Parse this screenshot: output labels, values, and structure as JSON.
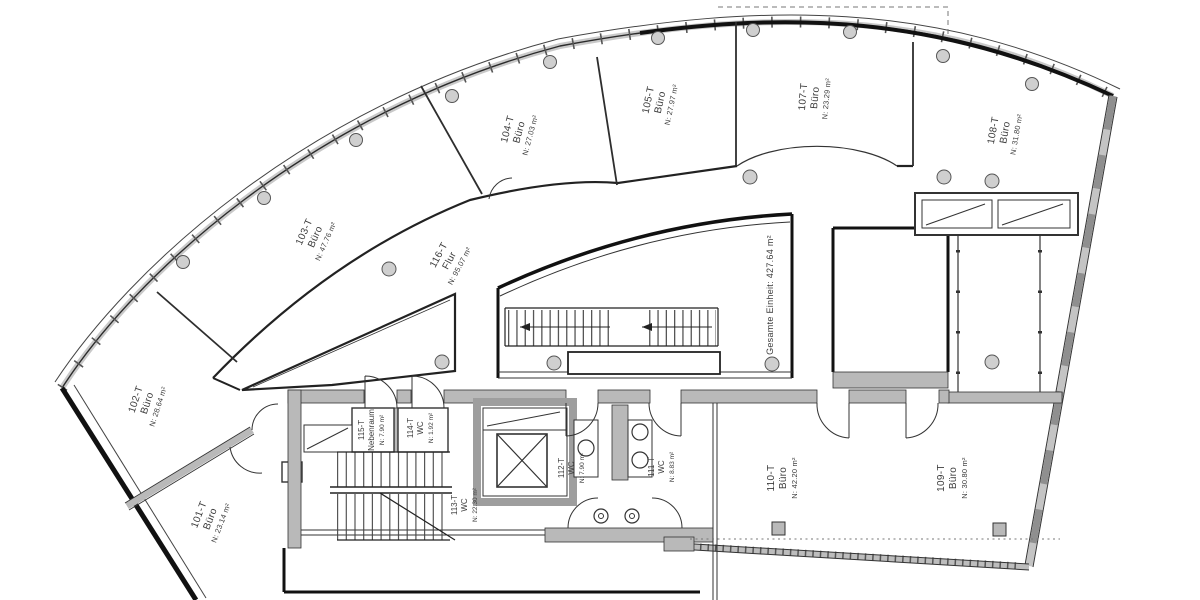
{
  "plan": {
    "total_label": "Gesamte Einheit: 427.64 m²",
    "rooms": [
      {
        "id": "101-T",
        "name": "Büro",
        "area": "N: 23.14 m²"
      },
      {
        "id": "102-T",
        "name": "Büro",
        "area": "N: 28.64 m²"
      },
      {
        "id": "103-T",
        "name": "Büro",
        "area": "N: 47.76 m²"
      },
      {
        "id": "104-T",
        "name": "Büro",
        "area": "N: 27.03 m²"
      },
      {
        "id": "105-T",
        "name": "Büro",
        "area": "N: 27.97 m²"
      },
      {
        "id": "107-T",
        "name": "Büro",
        "area": "N: 23.29 m²"
      },
      {
        "id": "108-T",
        "name": "Büro",
        "area": "N: 31.80 m²"
      },
      {
        "id": "109-T",
        "name": "Büro",
        "area": "N: 30.80 m²"
      },
      {
        "id": "110-T",
        "name": "Büro",
        "area": "N: 42.20 m²"
      },
      {
        "id": "111-T",
        "name": "WC",
        "area": "N: 8.83 m²"
      },
      {
        "id": "112-T",
        "name": "WC",
        "area": "N: 7.90 m²"
      },
      {
        "id": "113-T",
        "name": "WC",
        "area": "N: 22.30 m²"
      },
      {
        "id": "114-T",
        "name": "WC",
        "area": "N: 1.92 m²"
      },
      {
        "id": "115-T",
        "name": "Nebenraum",
        "area": "N: 7.90 m²"
      },
      {
        "id": "116-T",
        "name": "Flur",
        "area": "N: 95.07 m²"
      }
    ]
  }
}
